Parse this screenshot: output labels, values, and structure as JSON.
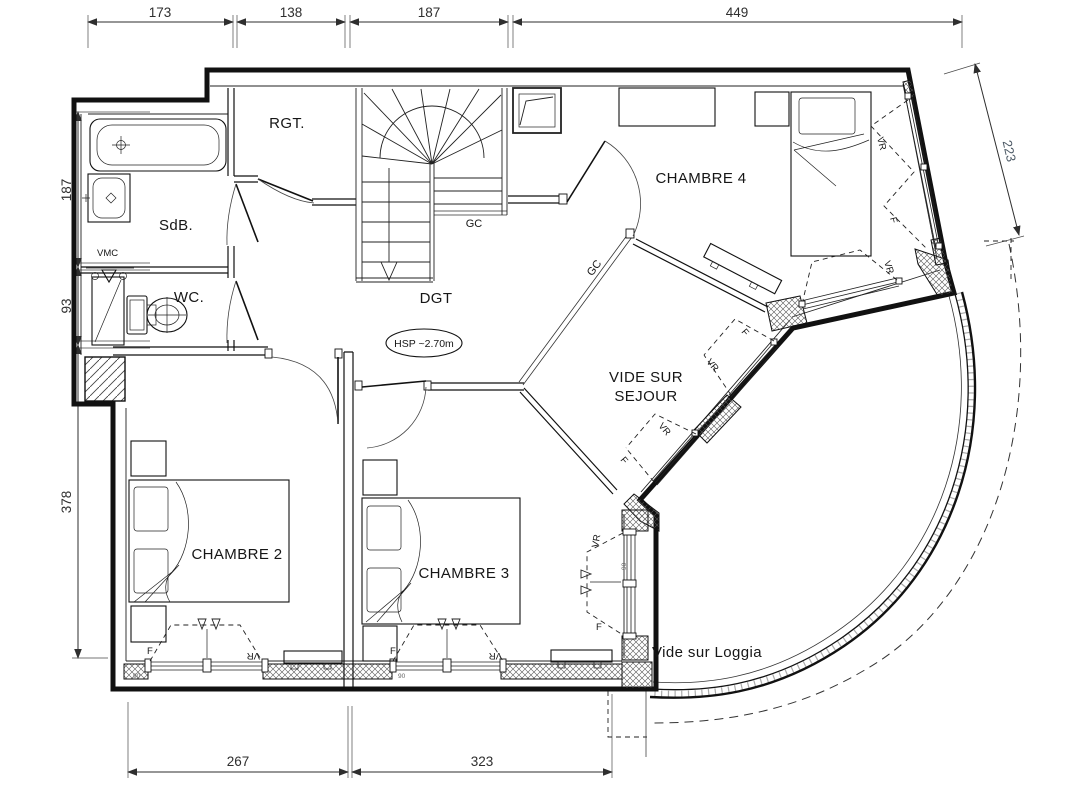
{
  "meta": {
    "drawing_type": "architectural floor plan (upper storey)",
    "width_px": 1079,
    "height_px": 800
  },
  "colors": {
    "background": "#ffffff",
    "line": "#111111",
    "dim_text": "#2e2e2e",
    "dim_text_alt": "#4d5a66"
  },
  "rooms": {
    "rgt": {
      "label": "RGT."
    },
    "sdb": {
      "label": "SdB."
    },
    "wc": {
      "label": "WC."
    },
    "dgt": {
      "label": "DGT"
    },
    "chambre2": {
      "label": "CHAMBRE 2"
    },
    "chambre3": {
      "label": "CHAMBRE 3"
    },
    "chambre4": {
      "label": "CHAMBRE 4"
    },
    "vide_sejour": {
      "line1": "VIDE SUR",
      "line2": "SEJOUR"
    },
    "vide_loggia": {
      "label": "Vide sur Loggia"
    }
  },
  "annotations": {
    "vmc": "VMC",
    "gc": "GC",
    "hsp": "HSP ~2.70m",
    "window_f": "F",
    "window_vr": "VR",
    "sill_mark": "90"
  },
  "dimensions": {
    "top": [
      "173",
      "138",
      "187",
      "449"
    ],
    "left": [
      "187",
      "93",
      "378"
    ],
    "right": [
      "223"
    ],
    "bottom": [
      "267",
      "323"
    ]
  }
}
